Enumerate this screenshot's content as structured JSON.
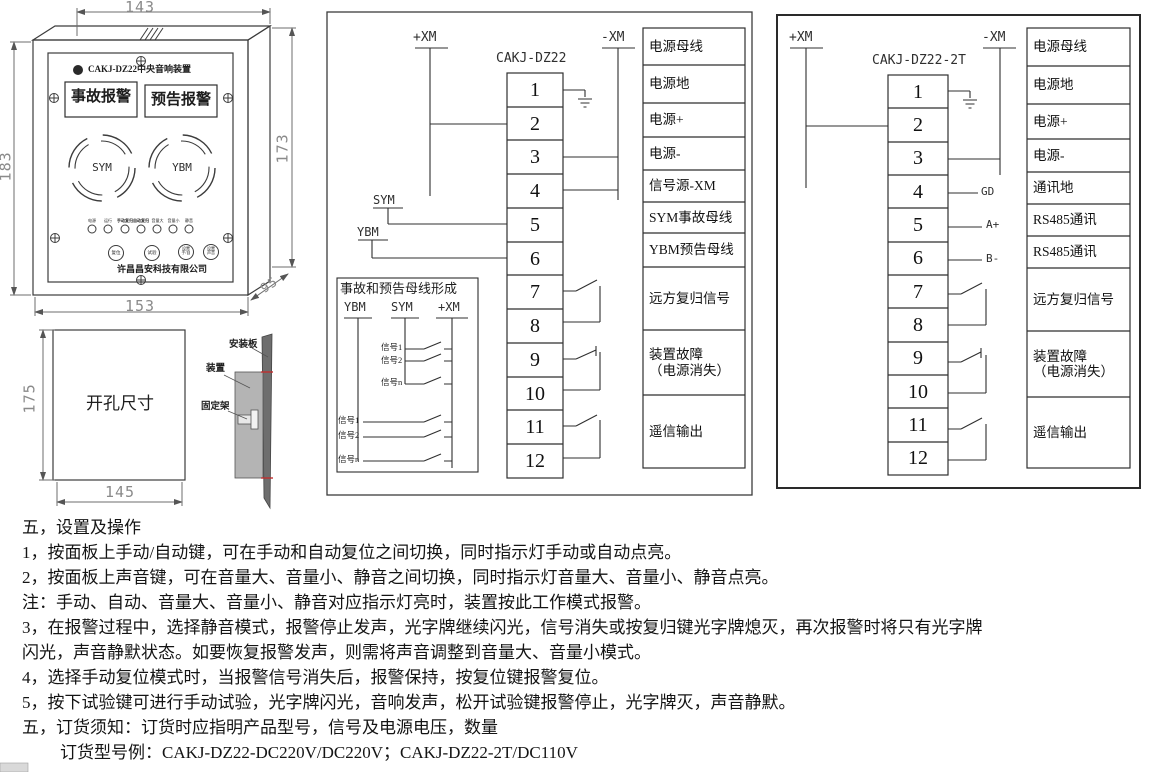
{
  "panel_drawing": {
    "title": "CAKJ-DZ22中央音响装置",
    "window_accident": "事故报警",
    "window_forecast": "预告报警",
    "speaker_left": "SYM",
    "speaker_right": "YBM",
    "led_labels": [
      "电源",
      "运行",
      "手动复归",
      "自动复归",
      "音量大",
      "音量小",
      "静音"
    ],
    "buttons": [
      "复位",
      "试验",
      "设置\n手/自",
      "设置\n声音"
    ],
    "company": "许昌昌安科技有限公司",
    "dims": {
      "top": "143",
      "left": "183",
      "right": "173",
      "bottom": "153",
      "depth": "95"
    }
  },
  "cutout_drawing": {
    "label": "开孔尺寸",
    "dim_height": "175",
    "dim_width": "145",
    "plate_label": "安装板",
    "device_label": "装置",
    "bracket_label": "固定架"
  },
  "diagram_dz22": {
    "title": "CAKJ-DZ22",
    "bus_plus": "+XM",
    "bus_minus": "-XM",
    "sym": "SYM",
    "ybm": "YBM",
    "terminals": [
      "1",
      "2",
      "3",
      "4",
      "5",
      "6",
      "7",
      "8",
      "9",
      "10",
      "11",
      "12"
    ],
    "labels": [
      "电源母线",
      "电源地",
      "电源+",
      "电源-",
      "信号源-XM",
      "SYM事故母线",
      "YBM预告母线",
      "远方复归信号",
      "装置故障\n（电源消失）",
      "遥信输出"
    ],
    "formation_box": {
      "title": "事故和预告母线形成",
      "header_ybm": "YBM",
      "header_sym": "SYM",
      "header_xm": "+XM",
      "sym_signals": [
        "信号1",
        "信号2",
        "信号n"
      ],
      "ybm_signals": [
        "信号1",
        "信号2",
        "信号n"
      ]
    }
  },
  "diagram_dz22_2t": {
    "title": "CAKJ-DZ22-2T",
    "bus_plus": "+XM",
    "bus_minus": "-XM",
    "terminals": [
      "1",
      "2",
      "3",
      "4",
      "5",
      "6",
      "7",
      "8",
      "9",
      "10",
      "11",
      "12"
    ],
    "pin_gd": "GD",
    "pin_a": "A+",
    "pin_b": "B-",
    "labels": [
      "电源母线",
      "电源地",
      "电源+",
      "电源-",
      "通讯地",
      "RS485通讯",
      "RS485通讯",
      "远方复归信号",
      "装置故障\n（电源消失）",
      "遥信输出"
    ]
  },
  "instructions": {
    "lines": [
      "五，设置及操作",
      "1，按面板上手动/自动键，可在手动和自动复位之间切换，同时指示灯手动或自动点亮。",
      "2，按面板上声音键，可在音量大、音量小、静音之间切换，同时指示灯音量大、音量小、静音点亮。",
      "注：手动、自动、音量大、音量小、静音对应指示灯亮时，装置按此工作模式报警。",
      "3，在报警过程中，选择静音模式，报警停止发声，光字牌继续闪光，信号消失或按复归键光字牌熄灭，再次报警时将只有光字牌",
      "闪光，声音静默状态。如要恢复报警发声，则需将声音调整到音量大、音量小模式。",
      "4，选择手动复位模式时，当报警信号消失后，报警保持，按复位键报警复位。",
      "5，按下试验键可进行手动试验，光字牌闪光，音响发声，松开试验键报警停止，光字牌灭，声音静默。",
      "五，订货须知：订货时应指明产品型号，信号及电源电压，数量",
      "订货型号例：CAKJ-DZ22-DC220V/DC220V；CAKJ-DZ22-2T/DC110V"
    ]
  }
}
